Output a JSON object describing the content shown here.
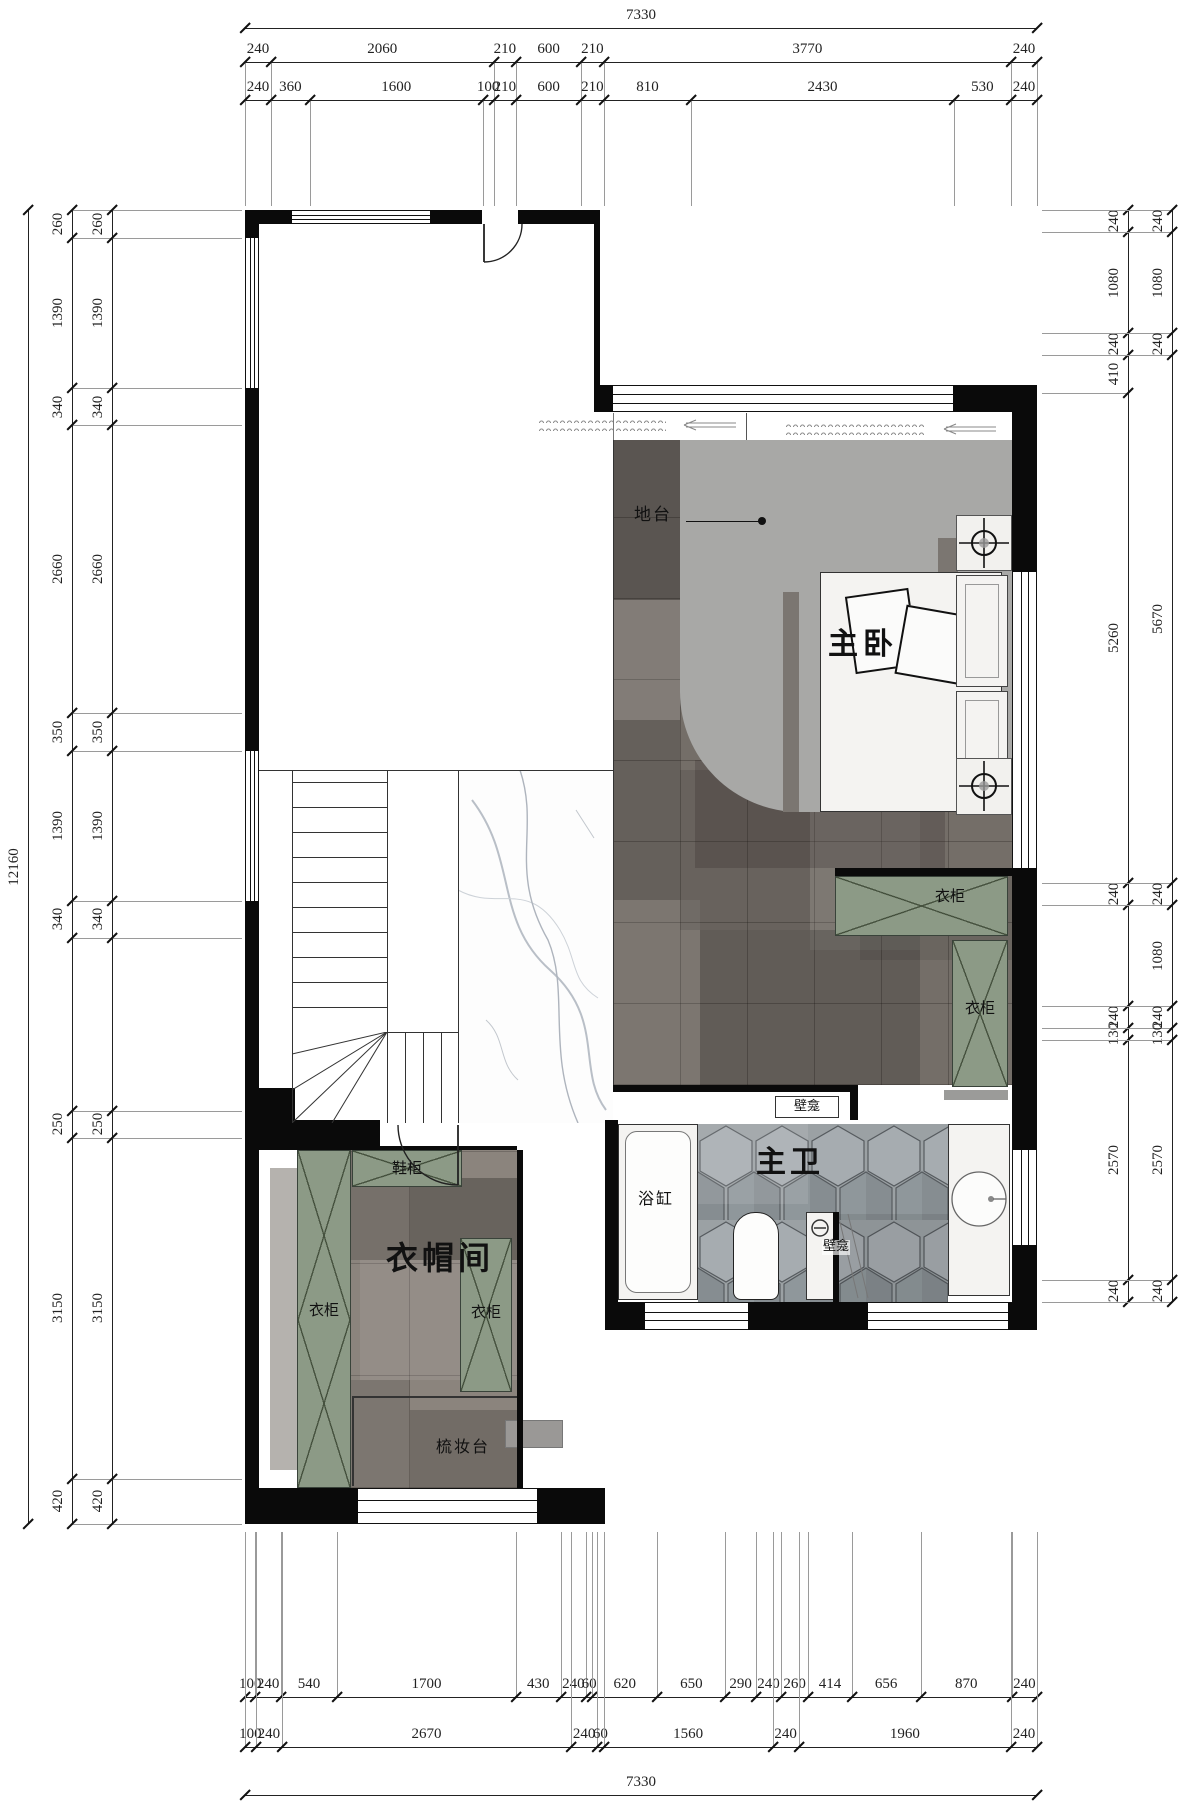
{
  "floorplan": {
    "labels": {
      "master_bedroom": "主卧",
      "master_bath": "主卫",
      "walk_in_closet": "衣帽间",
      "platform": "地台",
      "wardrobe": "衣柜",
      "shoe_cabinet": "鞋柜",
      "dressing_table": "梳妆台",
      "bathtub": "浴缸",
      "niche": "壁龛"
    },
    "colors": {
      "wall": "#0a0a0a",
      "wardrobe_green": "#8c9a86",
      "platform_gray": "#a8a8a6",
      "tile_dark": "#746e68",
      "tile_light": "#8b847d",
      "hex_tile": "#9ba1a4",
      "marble_vein": "#b9bfc7"
    }
  },
  "dims": {
    "top": {
      "overall": "7330",
      "coarse": [
        240,
        2060,
        210,
        600,
        210,
        3770,
        240
      ],
      "fine": [
        240,
        360,
        1600,
        100,
        210,
        600,
        210,
        810,
        2430,
        530,
        240
      ]
    },
    "bottom": {
      "overall": "7330",
      "fine": [
        100,
        240,
        540,
        1700,
        430,
        240,
        60,
        620,
        650,
        290,
        240,
        260,
        414,
        656,
        870,
        240
      ],
      "coarse": [
        100,
        240,
        2670,
        240,
        60,
        1560,
        240,
        1960,
        240
      ]
    },
    "left": {
      "overall": "12160",
      "outer": [
        260,
        1390,
        340,
        2660,
        350,
        1390,
        340,
        {
          "v": 1600,
          "label": ""
        },
        250,
        3150,
        420
      ],
      "inner": [
        260,
        1390,
        340,
        2660,
        350,
        1390,
        340,
        {
          "v": 1600,
          "label": ""
        },
        250,
        3150,
        420
      ]
    },
    "right": {
      "inner": [
        240,
        1080,
        240,
        410,
        5260,
        240,
        {
          "v": 1080,
          "label": ""
        },
        240,
        130,
        2570,
        240
      ],
      "outer": [
        240,
        1080,
        240,
        5670,
        240,
        1080,
        240,
        130,
        2570,
        240
      ]
    }
  }
}
